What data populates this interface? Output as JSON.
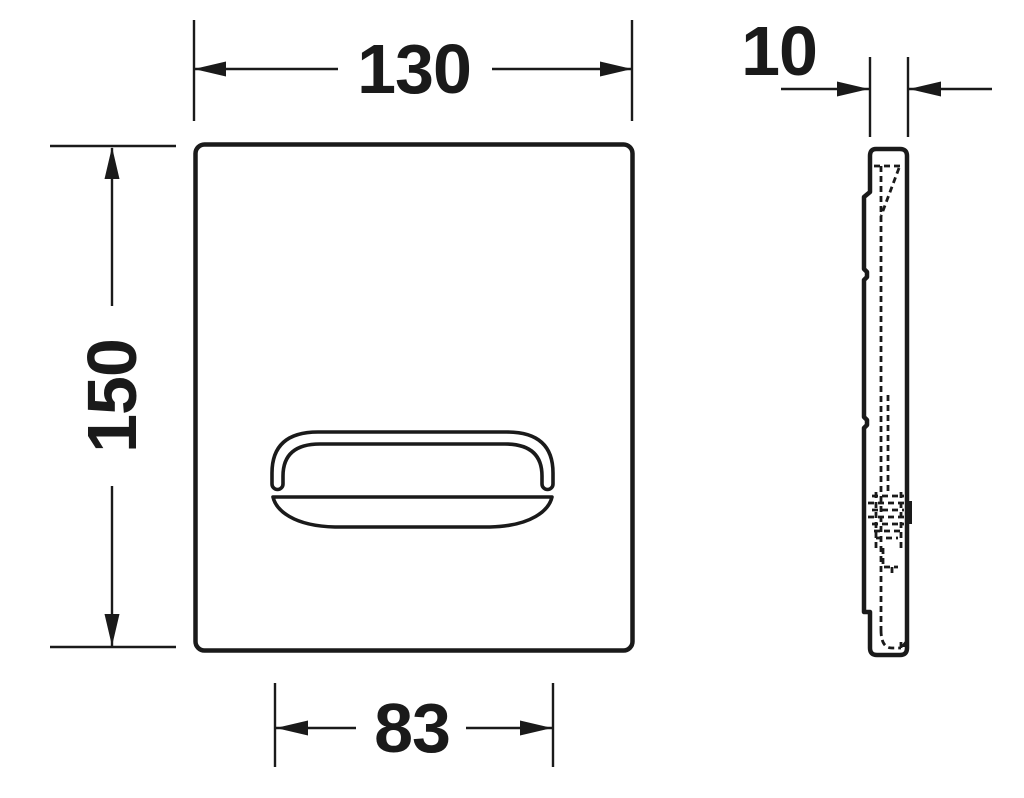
{
  "dimensions": {
    "width": "130",
    "height": "150",
    "depth": "10",
    "button_width": "83"
  },
  "colors": {
    "line": "#1a1a1a",
    "background": "#ffffff"
  }
}
